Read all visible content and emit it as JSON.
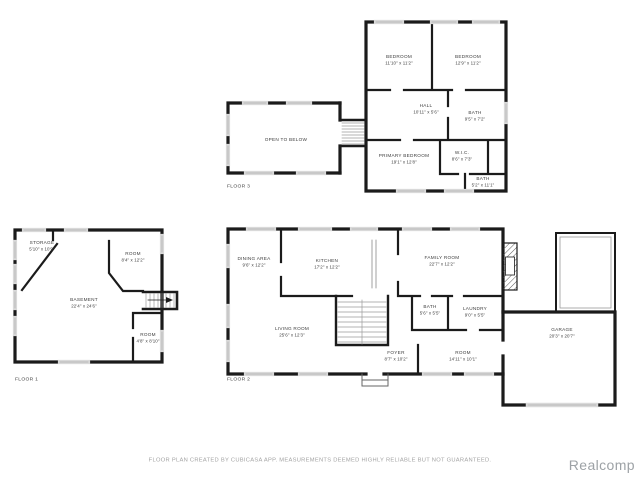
{
  "meta": {
    "footer": "FLOOR PLAN CREATED BY CUBICASA APP. MEASUREMENTS DEEMED HIGHLY RELIABLE BUT NOT GUARANTEED.",
    "watermark": "Realcomp",
    "colors": {
      "wall": "#1b1b1b",
      "window": "#d9d9d9",
      "label": "#3d3d3d",
      "muted": "#a3a3a3",
      "watermark": "#9da2a6"
    }
  },
  "floor3": {
    "label": "FLOOR 3",
    "rooms": [
      {
        "name": "BEDROOM",
        "dims": "11'10\" x 11'2\""
      },
      {
        "name": "BEDROOM",
        "dims": "12'9\" x 11'2\""
      },
      {
        "name": "HALL",
        "dims": "10'11\" x 5'6\""
      },
      {
        "name": "BATH",
        "dims": "9'5\" x 7'2\""
      },
      {
        "name": "PRIMARY BEDROOM",
        "dims": "19'1\" x 12'8\""
      },
      {
        "name": "W.I.C.",
        "dims": "8'6\" x 7'3\""
      },
      {
        "name": "BATH",
        "dims": "5'2\" x 11'1\""
      },
      {
        "name": "OPEN TO BELOW",
        "dims": ""
      }
    ]
  },
  "floor1": {
    "label": "FLOOR 1",
    "rooms": [
      {
        "name": "STORAGE",
        "dims": "5'10\" x 10'9\""
      },
      {
        "name": "ROOM",
        "dims": "8'4\" x 12'2\""
      },
      {
        "name": "BASEMENT",
        "dims": "22'4\" x 24'6\""
      },
      {
        "name": "ROOM",
        "dims": "4'8\" x 8'10\""
      }
    ]
  },
  "floor2": {
    "label": "FLOOR 2",
    "rooms": [
      {
        "name": "DINING AREA",
        "dims": "9'6\" x 12'2\""
      },
      {
        "name": "KITCHEN",
        "dims": "17'2\" x 12'2\""
      },
      {
        "name": "FAMILY ROOM",
        "dims": "22'7\" x 12'2\""
      },
      {
        "name": "LIVING ROOM",
        "dims": "25'6\" x 12'3\""
      },
      {
        "name": "BATH",
        "dims": "5'6\" x 5'5\""
      },
      {
        "name": "LAUNDRY",
        "dims": "9'0\" x 5'5\""
      },
      {
        "name": "FOYER",
        "dims": "8'7\" x 10'2\""
      },
      {
        "name": "ROOM",
        "dims": "14'11\" x 10'1\""
      },
      {
        "name": "GARAGE",
        "dims": "20'3\" x 20'7\""
      }
    ]
  }
}
